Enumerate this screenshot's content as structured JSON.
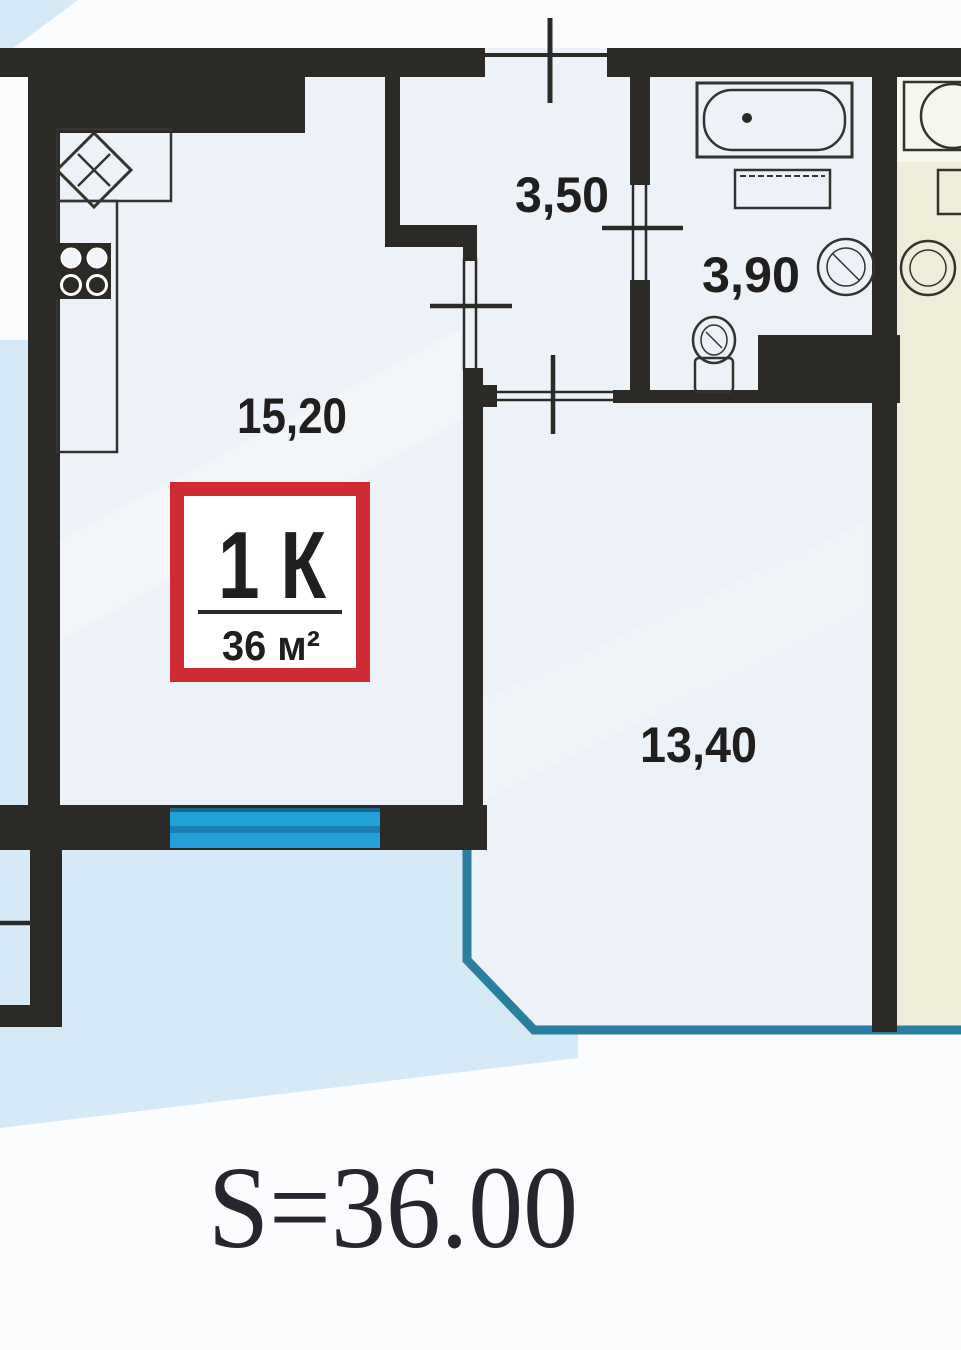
{
  "title": "Apartment floor plan",
  "labels": {
    "kitchen_area": "15,20",
    "hallway_area": "3,50",
    "bathroom_area": "3,90",
    "living_area": "13,40",
    "unit_type": "1 К",
    "unit_area": "36 м²",
    "total_area": "S=36.00"
  },
  "colors": {
    "bg": "#fbfcfd",
    "wall": "#2b2a27",
    "floor": "#ecf2f7",
    "beige": "#efecd9",
    "neighborWhite": "#f6f5ee",
    "shade": "#d5eaf6",
    "windowBlue": "#21a0da",
    "windowBlueDark": "#1b7fb4",
    "windowBlueEdge": "#16688f",
    "bayTeal": "#2a7ea0",
    "labelRed": "#ce2b32",
    "fixture": "#34332f",
    "text": "#201f1d",
    "totalText": "#26262e"
  }
}
